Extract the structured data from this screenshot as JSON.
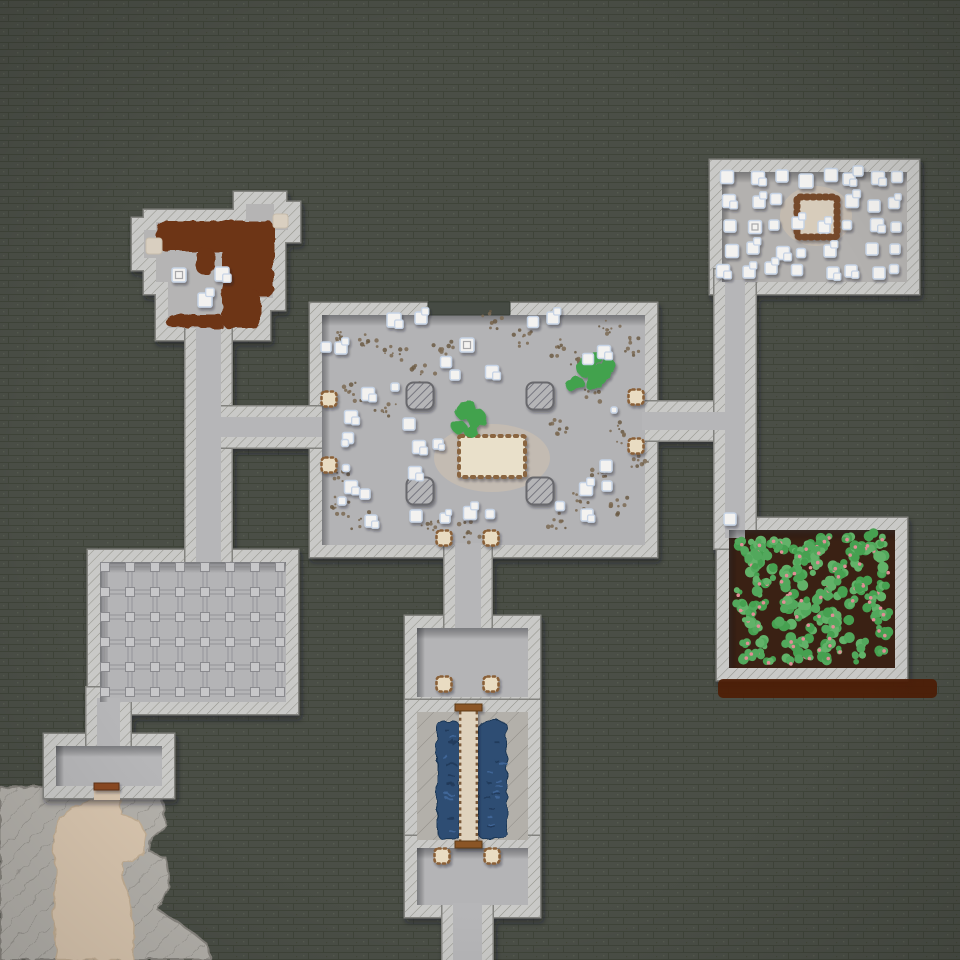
{
  "meta": {
    "app": "fortress-map-view",
    "canvas": {
      "w": 960,
      "h": 960
    }
  },
  "palette": {
    "bg": "#4a4e46",
    "bgLine": "#3f4439",
    "bgSpeck": "#565b50",
    "wall": "#c9c9c7",
    "wallHatch": "#94948c",
    "wallEdge": "#83837f",
    "floorHall": "#b3b3b5",
    "floorNE": "#b3b1af",
    "floorGrid": "#b4b4b6",
    "floorSmall": "#b6b6b8",
    "floorNW": "#b5b4b4",
    "floorCorridor": "#b6b6b8",
    "soil": "#3a2114",
    "plantGreens": [
      "#52a85c",
      "#46a050",
      "#62b269"
    ],
    "berry": "#e18e96",
    "brownStrip": "#4e1d05",
    "rock": "#b3b0aa",
    "rockHatch": "#8f8c86",
    "cave": "#d8c5ae",
    "water": "#2d4d73",
    "waterDark": "#203a59",
    "waterLight": "#41689a",
    "bridge": "#dfd2bd",
    "bridgeCap": "#8a5526",
    "bridgeTick": "#7a5838",
    "door": "#e9dcc2",
    "doorTick": "#8a6138",
    "table": "#e9e0ca",
    "tableTick": "#8a6540",
    "pen": "#d7ccbb",
    "penTick": "#75482a",
    "stain": "#6d3416",
    "dirt": "#7b6a53",
    "item": "#f3f2f0",
    "itemEdge": "#c6d3e5",
    "itemInner": "#a8a8aa",
    "pillar": "#b5b5b7",
    "pillarHatch": "#70707a",
    "pillarEdge": "#68686c",
    "gridLine": "#9a9a9e",
    "gridNode": "#c7c7c9",
    "gridNodeEdge": "#8a8a8e",
    "woodDoor": "#8a4a22",
    "woodDoorEdge": "#5e3012",
    "darkSeg": "#464b44",
    "patch": "#d9cfc0",
    "shade": "rgba(42,44,50,0.42)"
  },
  "names": {
    "door": "door",
    "item": "crate",
    "pillar": "pillar",
    "table": "great-table",
    "pen": "animal-pen",
    "bush": "bush",
    "bridge": "wooden-bridge",
    "woodDoor": "wooden-door",
    "water": "water-pool",
    "farm": "farm-plot",
    "grid": "storage-grid",
    "rock": "natural-rock",
    "cave": "cave-floor",
    "stain": "dirt-stain",
    "dirt": "rubble-speckle",
    "strip": "dirt-road",
    "darkSeg": "unbuilt-wall-segment",
    "patch": "floor-patch"
  },
  "rooms": [
    {
      "id": "nw-room",
      "poly": [
        [
          156,
          222
        ],
        [
          246,
          222
        ],
        [
          246,
          204
        ],
        [
          274,
          204
        ],
        [
          274,
          214
        ],
        [
          288,
          214
        ],
        [
          288,
          230
        ],
        [
          273,
          230
        ],
        [
          273,
          298
        ],
        [
          258,
          298
        ],
        [
          258,
          328
        ],
        [
          168,
          328
        ],
        [
          168,
          282
        ],
        [
          156,
          282
        ],
        [
          156,
          258
        ],
        [
          144,
          258
        ],
        [
          144,
          230
        ],
        [
          156,
          230
        ]
      ],
      "fill": "floorNW",
      "sw": 24
    },
    {
      "id": "great-hall",
      "rect": [
        322,
        315,
        323,
        230
      ],
      "fill": "floorHall",
      "sw": 24,
      "shade": true
    },
    {
      "id": "stockpile",
      "rect": [
        722,
        172,
        185,
        110
      ],
      "fill": "floorNE",
      "sw": 24,
      "shade": true
    },
    {
      "id": "farm",
      "rect": [
        729,
        530,
        166,
        138
      ],
      "fill": "soil",
      "sw": 24,
      "shade": true
    },
    {
      "id": "grid-room",
      "rect": [
        100,
        562,
        186,
        140
      ],
      "fill": "floorGrid",
      "sw": 24,
      "shade": true
    },
    {
      "id": "antechamber",
      "rect": [
        417,
        628,
        111,
        69
      ],
      "fill": "floorGrid",
      "sw": 24,
      "shade": true
    },
    {
      "id": "cistern",
      "rect": [
        417,
        712,
        111,
        128
      ],
      "fill": "rockpat",
      "sw": 24
    },
    {
      "id": "bottom-room",
      "rect": [
        417,
        848,
        111,
        57
      ],
      "fill": "floorGrid",
      "sw": 24,
      "shade": true
    },
    {
      "id": "sw-room",
      "rect": [
        56,
        746,
        106,
        40
      ],
      "fill": "floorSmall",
      "sw": 24,
      "shade": true
    }
  ],
  "corridors": [
    {
      "id": "c-nw-vertical",
      "rect": [
        196,
        320,
        25,
        246
      ]
    },
    {
      "id": "c-left",
      "rect": [
        208,
        417,
        116,
        20
      ]
    },
    {
      "id": "c-right",
      "rect": [
        642,
        412,
        88,
        18
      ]
    },
    {
      "id": "c-east-vertical",
      "rect": [
        725,
        280,
        20,
        258
      ]
    },
    {
      "id": "c-hall-south",
      "rect": [
        455,
        543,
        26,
        87
      ]
    },
    {
      "id": "c-grid-south",
      "rect": [
        97,
        698,
        23,
        52
      ]
    },
    {
      "id": "c-bottom-exit",
      "rect": [
        453,
        903,
        29,
        59
      ]
    }
  ],
  "dark_segment": [
    428,
    302,
    82,
    13
  ],
  "brown_strip": [
    718,
    679,
    219,
    19
  ],
  "rock_sw": [
    [
      0,
      788
    ],
    [
      96,
      784
    ],
    [
      119,
      784
    ],
    [
      150,
      788
    ],
    [
      163,
      800
    ],
    [
      166,
      826
    ],
    [
      152,
      838
    ],
    [
      150,
      852
    ],
    [
      166,
      858
    ],
    [
      170,
      886
    ],
    [
      158,
      910
    ],
    [
      178,
      922
    ],
    [
      205,
      942
    ],
    [
      212,
      960
    ],
    [
      0,
      960
    ]
  ],
  "cave_floor": [
    [
      93,
      786
    ],
    [
      121,
      786
    ],
    [
      121,
      814
    ],
    [
      138,
      820
    ],
    [
      146,
      834
    ],
    [
      143,
      856
    ],
    [
      124,
      862
    ],
    [
      121,
      874
    ],
    [
      130,
      900
    ],
    [
      134,
      926
    ],
    [
      133,
      960
    ],
    [
      57,
      960
    ],
    [
      53,
      914
    ],
    [
      57,
      872
    ],
    [
      52,
      844
    ],
    [
      60,
      818
    ],
    [
      76,
      806
    ],
    [
      93,
      800
    ]
  ],
  "cave_door_gap": [
    94,
    786,
    26,
    14
  ],
  "wood_door": [
    94,
    783,
    25,
    7
  ],
  "cistern_content": {
    "pools": [
      [
        437,
        721,
        23,
        118
      ],
      [
        478,
        721,
        29,
        118
      ]
    ],
    "bridge": [
      459,
      705,
      19,
      143
    ],
    "caps": [
      [
        455,
        704,
        27,
        7
      ],
      [
        455,
        841,
        27,
        7
      ]
    ],
    "dash_seed": 11,
    "dashes_per_pool": 16
  },
  "grid": {
    "x0": 105,
    "y0": 567,
    "cols": 8,
    "rows": 6,
    "step": 25,
    "node": 9
  },
  "farm_plants": {
    "seed": 42,
    "count": 140,
    "area": [
      735,
      537,
      152,
      126
    ]
  },
  "stains_nw": [
    [
      156,
      221,
      118,
      30
    ],
    [
      222,
      221,
      52,
      76
    ],
    [
      196,
      248,
      18,
      26
    ],
    [
      222,
      290,
      38,
      38
    ],
    [
      166,
      314,
      58,
      14
    ]
  ],
  "patches_nw": [
    [
      146,
      238,
      16,
      16
    ],
    [
      273,
      214,
      15,
      14
    ]
  ],
  "halos": [
    [
      492,
      458,
      58,
      34
    ],
    [
      816,
      216,
      36,
      30
    ]
  ],
  "pillars": {
    "centers": [
      [
        420,
        396
      ],
      [
        540,
        396
      ],
      [
        420,
        491
      ],
      [
        540,
        491
      ]
    ],
    "size": 27
  },
  "table": [
    459,
    436,
    66,
    41
  ],
  "pen": [
    797,
    197,
    40,
    40
  ],
  "doors": [
    [
      329,
      399
    ],
    [
      329,
      465
    ],
    [
      636,
      397
    ],
    [
      636,
      446
    ],
    [
      444,
      538
    ],
    [
      491,
      538
    ],
    [
      444,
      684
    ],
    [
      491,
      684
    ],
    [
      442,
      856
    ],
    [
      492,
      856
    ]
  ],
  "bushes": [
    [
      [
        464,
        411,
        9
      ],
      [
        477,
        419,
        10
      ],
      [
        459,
        427,
        7
      ],
      [
        471,
        431,
        7
      ],
      [
        470,
        407,
        6
      ]
    ],
    [
      [
        586,
        367,
        10
      ],
      [
        601,
        373,
        10
      ],
      [
        577,
        382,
        6
      ],
      [
        593,
        383,
        8
      ],
      [
        608,
        365,
        7
      ],
      [
        571,
        386,
        5
      ],
      [
        596,
        357,
        6
      ]
    ]
  ],
  "dirt": {
    "seed": 7,
    "n": 9,
    "spread": 14,
    "clusters": [
      [
        340,
        338
      ],
      [
        368,
        342
      ],
      [
        396,
        356
      ],
      [
        422,
        372
      ],
      [
        352,
        392
      ],
      [
        386,
        412
      ],
      [
        446,
        350
      ],
      [
        492,
        322
      ],
      [
        521,
        337
      ],
      [
        558,
        347
      ],
      [
        578,
        362
      ],
      [
        608,
        330
      ],
      [
        633,
        347
      ],
      [
        598,
        392
      ],
      [
        560,
        428
      ],
      [
        622,
        432
      ],
      [
        638,
        462
      ],
      [
        602,
        472
      ],
      [
        580,
        502
      ],
      [
        624,
        506
      ],
      [
        560,
        522
      ],
      [
        430,
        524
      ],
      [
        342,
        472
      ],
      [
        338,
        504
      ],
      [
        468,
        532
      ],
      [
        360,
        520
      ]
    ]
  },
  "items": {
    "hall": [
      [
        394,
        320,
        "pair",
        14
      ],
      [
        421,
        318,
        "pair",
        12
      ],
      [
        533,
        322,
        "plain",
        11
      ],
      [
        553,
        318,
        "pair",
        12
      ],
      [
        467,
        345,
        "inner",
        14
      ],
      [
        604,
        352,
        "pair",
        13
      ],
      [
        588,
        359,
        "plain",
        11
      ],
      [
        446,
        362,
        "plain",
        11
      ],
      [
        455,
        375,
        "plain",
        10
      ],
      [
        492,
        372,
        "pair",
        13
      ],
      [
        368,
        394,
        "pair",
        13
      ],
      [
        395,
        387,
        "dot",
        8
      ],
      [
        341,
        348,
        "pair",
        12
      ],
      [
        326,
        347,
        "plain",
        10
      ],
      [
        351,
        417,
        "pair",
        13
      ],
      [
        348,
        438,
        "plain",
        11
      ],
      [
        419,
        447,
        "pair",
        13
      ],
      [
        438,
        444,
        "pair",
        10
      ],
      [
        409,
        424,
        "plain",
        12
      ],
      [
        415,
        473,
        "pair",
        13
      ],
      [
        351,
        487,
        "pair",
        13
      ],
      [
        342,
        501,
        "dot",
        8
      ],
      [
        365,
        494,
        "plain",
        10
      ],
      [
        371,
        521,
        "pair",
        12
      ],
      [
        416,
        516,
        "plain",
        12
      ],
      [
        445,
        518,
        "pair",
        10
      ],
      [
        470,
        513,
        "pair",
        13
      ],
      [
        490,
        514,
        "dot",
        9
      ],
      [
        606,
        466,
        "plain",
        12
      ],
      [
        586,
        489,
        "pair",
        13
      ],
      [
        607,
        486,
        "plain",
        10
      ],
      [
        587,
        515,
        "pair",
        12
      ],
      [
        560,
        506,
        "plain",
        9
      ],
      [
        614,
        410,
        "dot",
        6
      ],
      [
        345,
        443,
        "dot",
        7
      ],
      [
        346,
        468,
        "dot",
        7
      ]
    ],
    "stockpile": [
      [
        727,
        177,
        "plain",
        13
      ],
      [
        758,
        178,
        "pair",
        13
      ],
      [
        782,
        176,
        "plain",
        12
      ],
      [
        806,
        181,
        "plain",
        14
      ],
      [
        831,
        175,
        "plain",
        13
      ],
      [
        849,
        179,
        "pair",
        12
      ],
      [
        858,
        171,
        "plain",
        10
      ],
      [
        878,
        178,
        "pair",
        13
      ],
      [
        897,
        177,
        "plain",
        11
      ],
      [
        729,
        201,
        "pair",
        13
      ],
      [
        759,
        202,
        "pair",
        12
      ],
      [
        776,
        199,
        "plain",
        11
      ],
      [
        852,
        201,
        "pair",
        13
      ],
      [
        874,
        206,
        "plain",
        12
      ],
      [
        894,
        203,
        "pair",
        11
      ],
      [
        730,
        226,
        "plain",
        12
      ],
      [
        755,
        227,
        "inner",
        13
      ],
      [
        774,
        225,
        "plain",
        10
      ],
      [
        798,
        223,
        "pair",
        12
      ],
      [
        824,
        227,
        "pair",
        12
      ],
      [
        847,
        225,
        "dot",
        9
      ],
      [
        877,
        225,
        "pair",
        13
      ],
      [
        896,
        227,
        "plain",
        10
      ],
      [
        732,
        251,
        "plain",
        13
      ],
      [
        753,
        248,
        "pair",
        12
      ],
      [
        783,
        253,
        "pair",
        13
      ],
      [
        801,
        253,
        "dot",
        9
      ],
      [
        830,
        251,
        "pair",
        12
      ],
      [
        872,
        249,
        "plain",
        12
      ],
      [
        895,
        249,
        "dot",
        10
      ],
      [
        723,
        271,
        "pair",
        13
      ],
      [
        749,
        272,
        "pair",
        12
      ],
      [
        771,
        268,
        "pair",
        12
      ],
      [
        797,
        270,
        "plain",
        11
      ],
      [
        833,
        273,
        "pair",
        12
      ],
      [
        851,
        271,
        "pair",
        12
      ],
      [
        879,
        273,
        "plain",
        12
      ],
      [
        894,
        269,
        "dot",
        9
      ]
    ],
    "nw": [
      [
        179,
        275,
        "inner",
        14
      ],
      [
        222,
        274,
        "pair",
        14
      ],
      [
        205,
        300,
        "pair",
        14
      ]
    ],
    "misc": [
      [
        730,
        519,
        "plain",
        12
      ]
    ]
  }
}
